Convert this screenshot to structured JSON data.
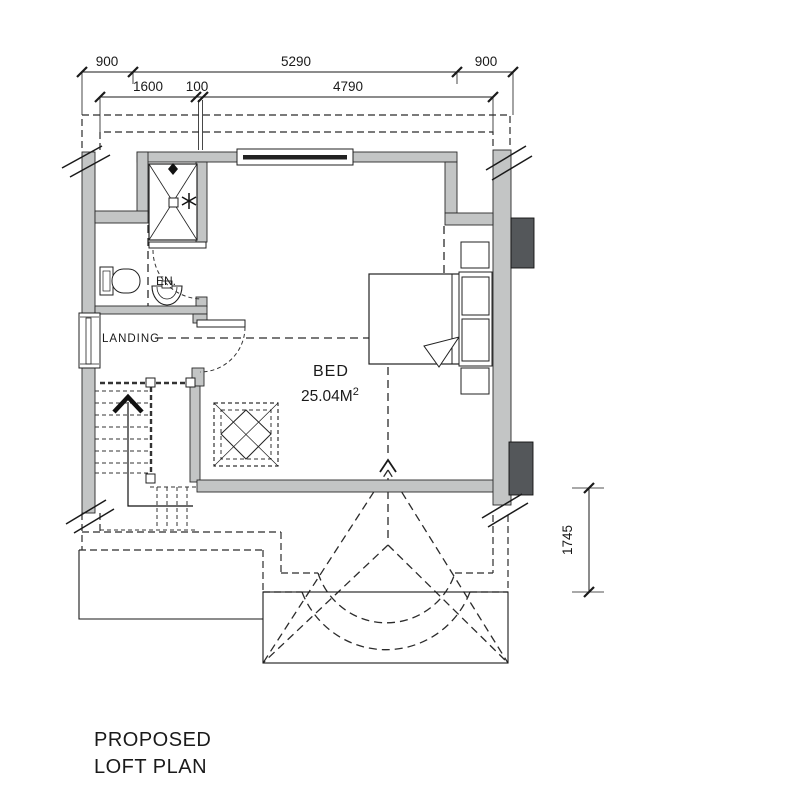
{
  "title": {
    "line1": "PROPOSED",
    "line2": "LOFT PLAN"
  },
  "dimensions": {
    "top_row": {
      "left": "900",
      "middle": "5290",
      "right": "900"
    },
    "second_row": {
      "left": "1600",
      "middle": "100",
      "right": "4790"
    },
    "right_side": "1745"
  },
  "labels": {
    "bedroom": "BED",
    "bedroom_area": "25.04M",
    "bedroom_area_sup": "2",
    "ensuite": "EN.",
    "landing": "LANDING"
  },
  "colors": {
    "wall": "#c3c5c5",
    "chimney": "#54575a",
    "line": "#1a1a1a",
    "dash": "#2b2b2b"
  }
}
